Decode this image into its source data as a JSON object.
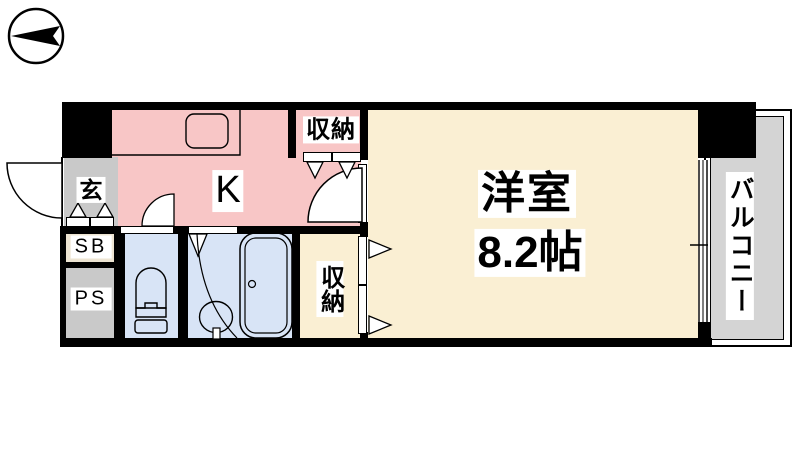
{
  "compass": {
    "icon": "north-arrow-left"
  },
  "floor_plan": {
    "rooms": {
      "entrance": {
        "label": "玄"
      },
      "kitchen": {
        "label": "K"
      },
      "kitchen_closet": {
        "label": "収納"
      },
      "shoe_box": {
        "label": "SB"
      },
      "pipe_space": {
        "label": "PS"
      },
      "hall_closet": {
        "label": "収納"
      },
      "western_room": {
        "label": "洋室",
        "size": "8.2帖"
      },
      "balcony": {
        "label": "バルコニー"
      }
    },
    "colors": {
      "kitchen": "#F8C6C6",
      "room": "#FAEFD3",
      "wet_area": "#D8E4F6",
      "gray_area": "#C9C9C9",
      "balcony": "#D4D4D4",
      "shoe_box_bg": "#EDE4D2",
      "wall": "#000000"
    }
  }
}
